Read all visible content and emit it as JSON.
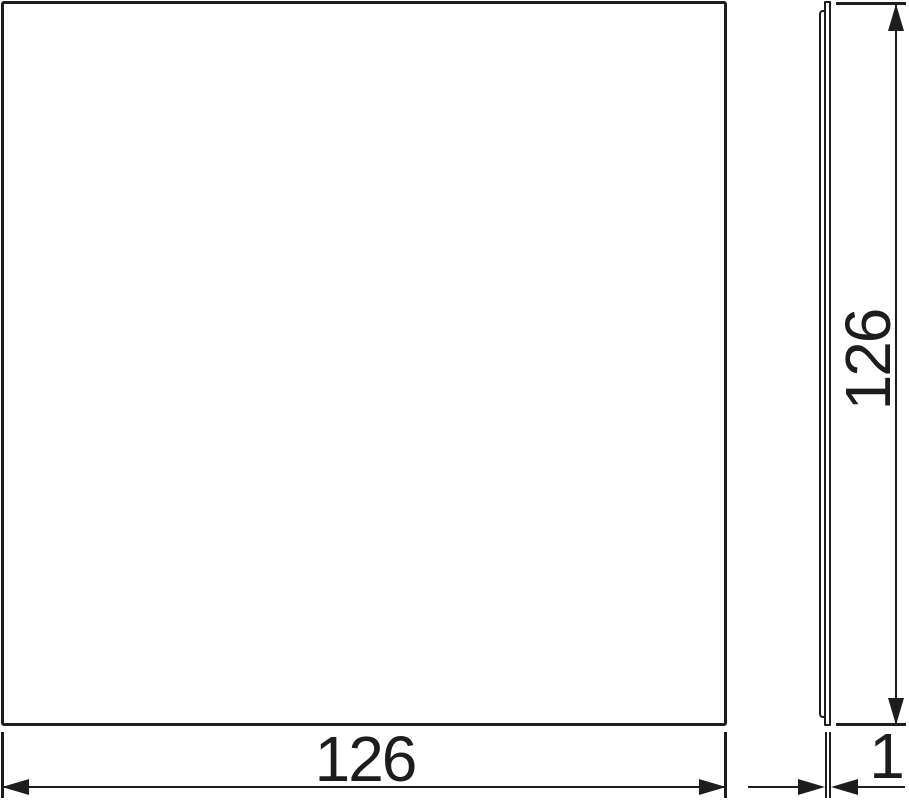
{
  "drawing": {
    "dimensions": {
      "width": {
        "value": "126"
      },
      "height": {
        "value": "126"
      },
      "thickness": {
        "value": "1"
      }
    },
    "colors": {
      "line": "#1d1d1b",
      "background": "#ffffff"
    }
  }
}
